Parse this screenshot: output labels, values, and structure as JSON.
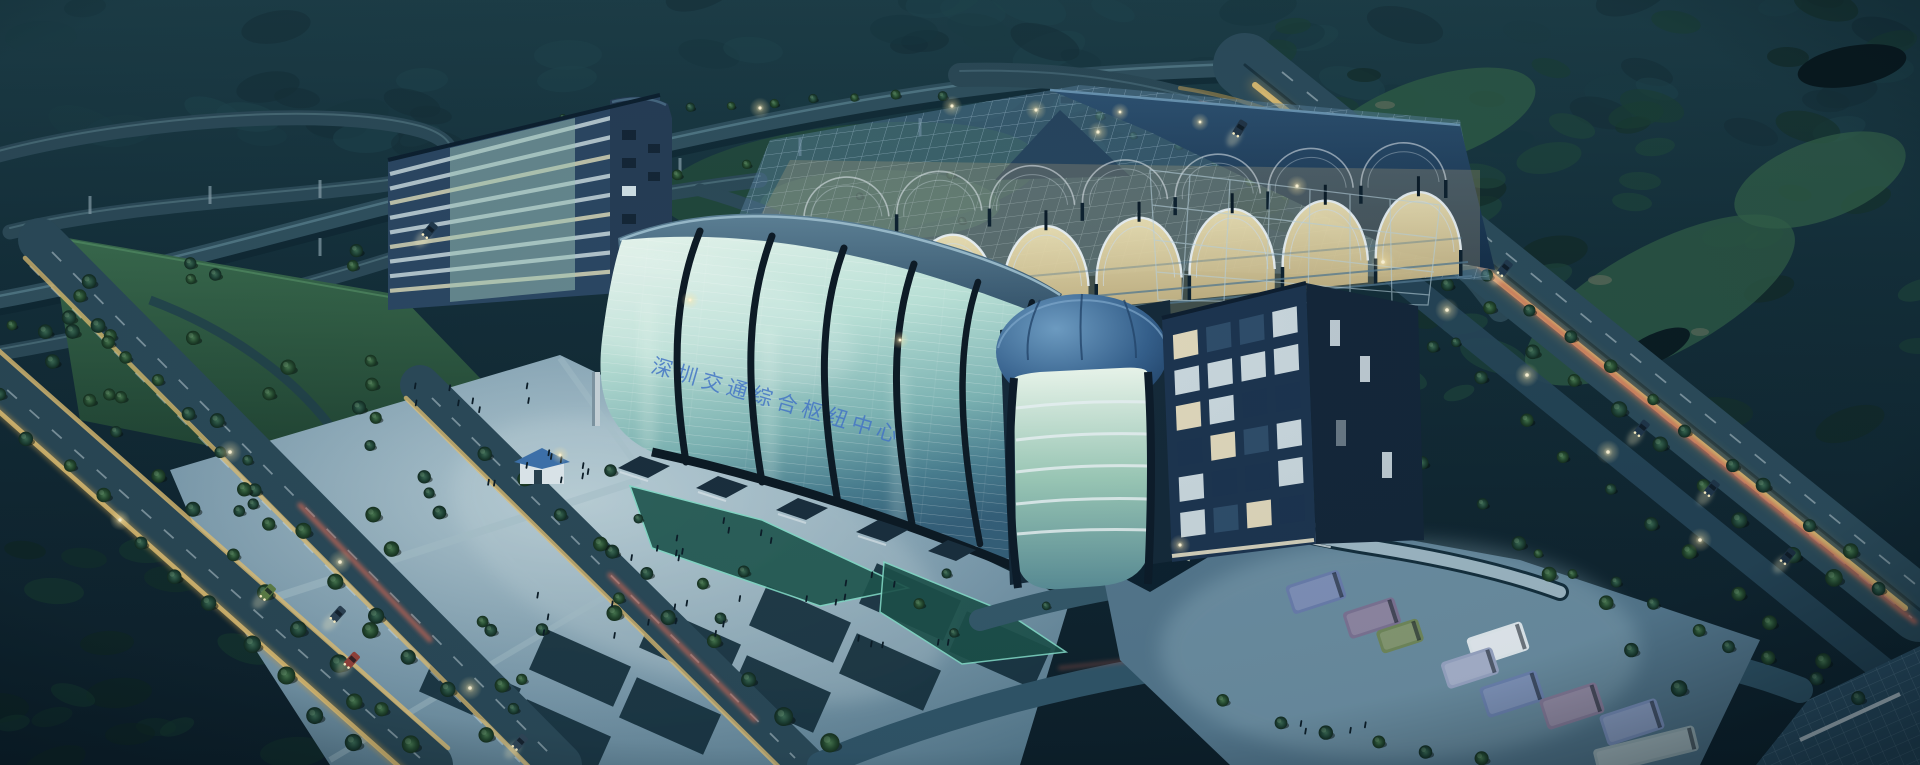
{
  "scene": {
    "type": "aerial-night-architectural-rendering",
    "setting": "Large glass transit-hub / exhibition complex at dusk beside a highway interchange, tree-lined boulevards and a golf course",
    "facade_banner_text": "深圳交通综合枢纽中心",
    "landmarks": [
      "highway-interchange",
      "tree-lined-boulevards",
      "curved-glass-exhibition-hall",
      "steel-lattice-platform-roof",
      "glass-dome-atrium-tower",
      "office-block",
      "mid-rise-striped-office-building",
      "public-plaza-with-crowds",
      "obelisk-monument",
      "reflecting-pools",
      "parking-lot-with-shuttle-vans",
      "golf-course",
      "forest-hills"
    ],
    "palette": {
      "night_sky_forest": "#16333c",
      "golf_green": "#2e5a46",
      "road_surface": "#2b4a59",
      "trail_yellow": "#e6c374",
      "trail_red": "#cf6a58",
      "glass_light": "#d9f0e6",
      "glass_deep": "#48808e",
      "roof_lattice": "#6f94ad",
      "roof_cap": "#203e58",
      "lit_interior": "#e2d4a4",
      "plaza": "#8fb0c0",
      "office_navy": "#1d3550",
      "tree_green": "#2c5138",
      "light_glow": "#ffe9a8",
      "banner_blue": "#4577c8"
    }
  }
}
